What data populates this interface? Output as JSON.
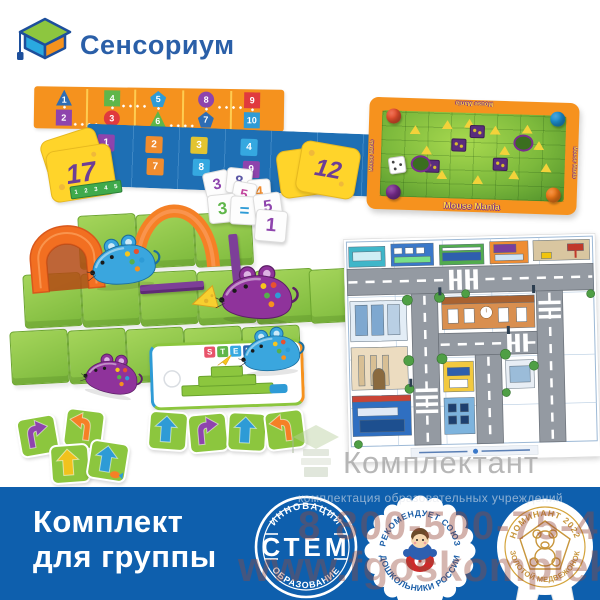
{
  "logo": {
    "text": "Сенсориум"
  },
  "watermark": {
    "brand": "Комплектант",
    "tagline": "комплектация образовательных учреждений",
    "phone": "8 800-500-75-40",
    "site": "www.fgoskomplekt.ru"
  },
  "banner": {
    "line1": "Комплект",
    "line2": "для группы",
    "bg_color": "#0e5fad"
  },
  "badges": {
    "stem": {
      "top": "ИННОВАЦИИ",
      "center": "СТЕМ",
      "bottom": "ОБРАЗОВАНИЕ"
    },
    "union": {
      "top": "РЕКОМЕНДУЕТ СОЮЗ",
      "bottom": "ДОШКОЛЬНИКИ РОССИИ"
    },
    "award": {
      "top": "НОМИНАНТ 2022",
      "bottom": "ЗОЛОТОЙ МЕДВЕЖОНОК"
    }
  },
  "kit": {
    "orange_board": {
      "color": "#f5921e",
      "cells": [
        {
          "num": "1",
          "shape": "triangle",
          "color": "#2e6db4"
        },
        {
          "num": "4",
          "shape": "square",
          "color": "#5fb64a"
        },
        {
          "num": "5",
          "shape": "pentagon",
          "color": "#2e9bd6"
        },
        {
          "num": "8",
          "shape": "circle",
          "color": "#8e44ad"
        },
        {
          "num": "9",
          "shape": "square",
          "color": "#e03a3e"
        },
        {
          "num": "2",
          "shape": "square",
          "color": "#8e44ad"
        },
        {
          "num": "3",
          "shape": "circle",
          "color": "#e03a3e"
        },
        {
          "num": "6",
          "shape": "triangle",
          "color": "#5fb64a"
        },
        {
          "num": "7",
          "shape": "pentagon",
          "color": "#2e6db4"
        },
        {
          "num": "10",
          "shape": "square",
          "color": "#2e9bd6"
        }
      ]
    },
    "blue_board": {
      "color": "#1e6fb4",
      "cells": [
        {
          "num": "1",
          "color": "#8e44ad"
        },
        {
          "num": "2",
          "color": "#f08c2e"
        },
        {
          "num": "3",
          "color": "#e2c431"
        },
        {
          "num": "4",
          "color": "#35a8e0"
        },
        {
          "num": "6",
          "color": "#5fb64a"
        },
        {
          "num": "7",
          "color": "#f08c2e"
        },
        {
          "num": "8",
          "color": "#35a8e0"
        },
        {
          "num": "9",
          "color": "#8e44ad"
        }
      ]
    },
    "cheese_cards": {
      "left": "17",
      "middle_front": "12",
      "middle_back": "2"
    },
    "ruler": {
      "numbers": [
        "1",
        "2",
        "3",
        "4",
        "5"
      ]
    },
    "dice": [
      {
        "value": "3",
        "color": "#8e44ad"
      },
      {
        "value": "8",
        "color": "#5b57a5"
      },
      {
        "value": "4",
        "color": "#f08c2e"
      },
      {
        "value": "5",
        "color": "#c2479e"
      },
      {
        "value": "3",
        "color": "#5fb64a"
      },
      {
        "value": "=",
        "color": "#2e9bd6"
      },
      {
        "value": "5",
        "color": "#8e44ad"
      },
      {
        "value": "1",
        "color": "#8e44ad"
      }
    ],
    "stem_card": {
      "letters": [
        {
          "ch": "S",
          "color": "#e8536a"
        },
        {
          "ch": "T",
          "color": "#5fb64a"
        },
        {
          "ch": "E",
          "color": "#35a8e0"
        },
        {
          "ch": "M",
          "color": "#2a66b0"
        }
      ]
    },
    "mouse_mania": {
      "title": "Mouse Mania",
      "frame_color": "#f6921e"
    },
    "arrow_cards": [
      {
        "type": "turn",
        "dir": "right",
        "color": "#8e44ad"
      },
      {
        "type": "turn",
        "dir": "left",
        "color": "#f58026"
      },
      {
        "type": "straight",
        "dir": "up",
        "color": "#f1c21d"
      },
      {
        "type": "straight",
        "dir": "up",
        "color": "#2e9bd6",
        "sticker": true
      },
      {
        "type": "straight",
        "dir": "up",
        "color": "#2e9bd6"
      },
      {
        "type": "turn",
        "dir": "right",
        "color": "#8e44ad"
      },
      {
        "type": "straight",
        "dir": "up",
        "color": "#2e9bd6"
      },
      {
        "type": "turn",
        "dir": "left",
        "color": "#f58026"
      }
    ],
    "mice": [
      {
        "name": "robot-mouse-blue-maze",
        "color": "blue"
      },
      {
        "name": "robot-mouse-purple-maze",
        "color": "purple"
      },
      {
        "name": "robot-mouse-purple-floor",
        "color": "purple"
      },
      {
        "name": "robot-mouse-blue-floor",
        "color": "blue"
      }
    ]
  }
}
